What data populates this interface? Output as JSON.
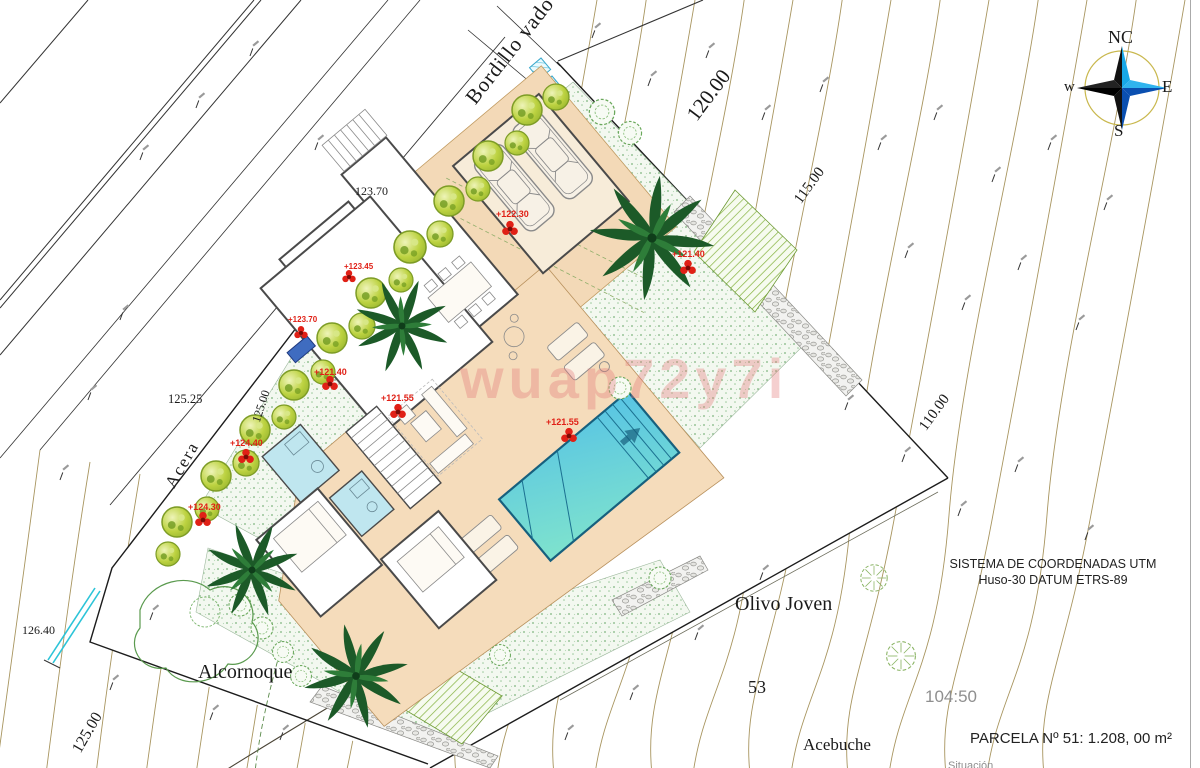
{
  "plan": {
    "street_labels": {
      "bordillo_vado": "Bordillo vado",
      "acera": "Acera"
    },
    "contour_labels": {
      "c120": "120.00",
      "c115": "115.00",
      "c110": "110.00",
      "c125": "125.00",
      "c125_boundary": "125.00",
      "spot_123_70": "123.70",
      "spot_125_25": "125.25",
      "spot_126_40": "126.40",
      "spot_104_50": "104:50"
    },
    "vegetation_labels": {
      "alcornoque": "Alcornoque",
      "olivo_joven": "Olivo Joven",
      "olivo_number": "53",
      "acebuche": "Acebuche"
    },
    "elevation_markers": [
      {
        "value": "+122.30"
      },
      {
        "value": "+121.40"
      },
      {
        "value": "+123.45"
      },
      {
        "value": "+123.70"
      },
      {
        "value": "+121.40"
      },
      {
        "value": "+121.55"
      },
      {
        "value": "+121.55"
      },
      {
        "value": "+124.40"
      },
      {
        "value": "+124.30"
      }
    ],
    "compass": {
      "north": "NC",
      "west": "w",
      "east": "E",
      "south": "S"
    },
    "notes": {
      "crs_line1": "SISTEMA DE COORDENADAS UTM",
      "crs_line2": "Huso-30 DATUM ETRS-89",
      "parcel": "PARCELA Nº 51: 1.208, 00 m²",
      "situacion": "Situación"
    },
    "watermark": "wuap72y7i",
    "colors": {
      "terrace": "#f5dcbb",
      "driveway": "#f3d9b7",
      "pool_light": "#58c4e4",
      "pool_dark": "#7fe3cd",
      "gravel_dot": "#7db37d",
      "hedge": "#b9cf3e",
      "palm": "#1c5a28",
      "marker_red": "#e02016",
      "contour": "#a8955f",
      "bath": "#bfe6ef",
      "compass_blue": "#18a8e8"
    }
  }
}
